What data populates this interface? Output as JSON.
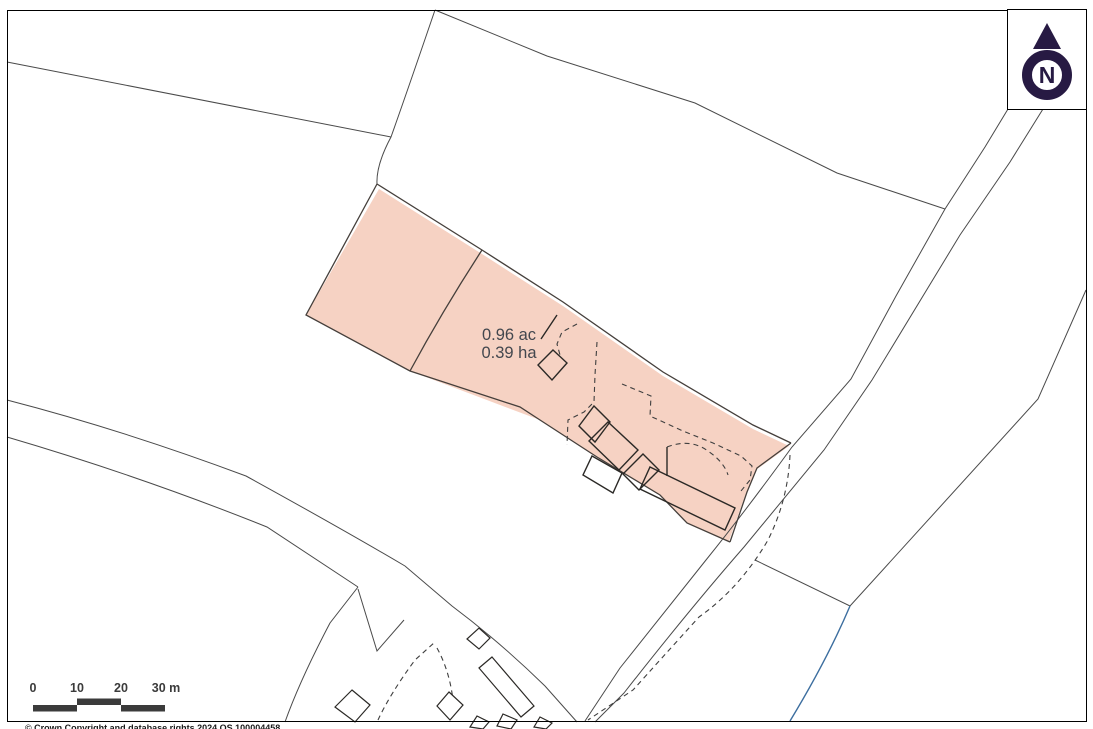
{
  "map": {
    "area_label": {
      "acres": "0.96 ac",
      "hectares": "0.39 ha"
    },
    "north_indicator": {
      "label": "N"
    },
    "scale_bar": {
      "ticks": [
        "0",
        "10",
        "20",
        "30 m"
      ]
    },
    "copyright": "© Crown Copyright and database rights 2024 OS 100004458"
  },
  "colors": {
    "parcel_fill": "#f6d2c3",
    "parcel_stroke": "#453f3b",
    "field_line": "#4a4a4a",
    "dashed_line": "#3f3f3f",
    "building_stroke": "#2b2926",
    "water": "#3c6e9f",
    "north": "#271a43",
    "scale_bar": "#3b3b3b",
    "label_text": "#43474e",
    "frame": "#000000",
    "copyright_text": "#1a1a1a"
  }
}
